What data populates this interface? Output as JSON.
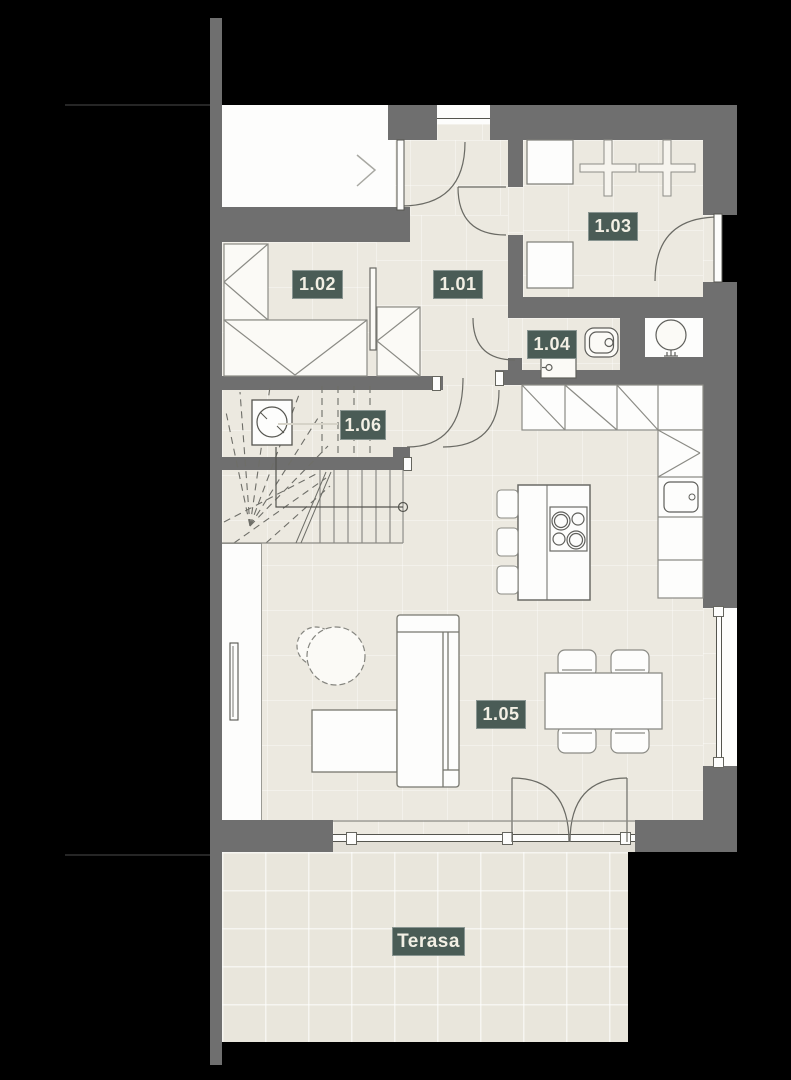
{
  "plan": {
    "title": "Floor plan — ground floor",
    "rooms": [
      {
        "id": "1.01"
      },
      {
        "id": "1.02"
      },
      {
        "id": "1.03"
      },
      {
        "id": "1.04"
      },
      {
        "id": "1.05"
      },
      {
        "id": "1.06"
      }
    ],
    "terrace_label": "Terasa",
    "colors": {
      "background": "#000000",
      "wall": "#6f6f6f",
      "floor": "#ece9e0",
      "floor_white": "#fdfdfc",
      "label_bg": "#4a5c56",
      "label_text": "#f2efe4",
      "line": "#8b8b85"
    },
    "icons": [
      "entrance-arrow-icon",
      "door-swing-icon",
      "window-icon",
      "stairs-icon",
      "chimney-icon",
      "boiler-icon",
      "toilet-icon",
      "sink-icon",
      "cooktop-icon",
      "kitchen-sink-icon",
      "sofa-icon",
      "coffee-table-icon",
      "dining-table-icon",
      "chair-icon",
      "wardrobe-icon",
      "dryer-cross-icon",
      "radiator-icon"
    ]
  }
}
